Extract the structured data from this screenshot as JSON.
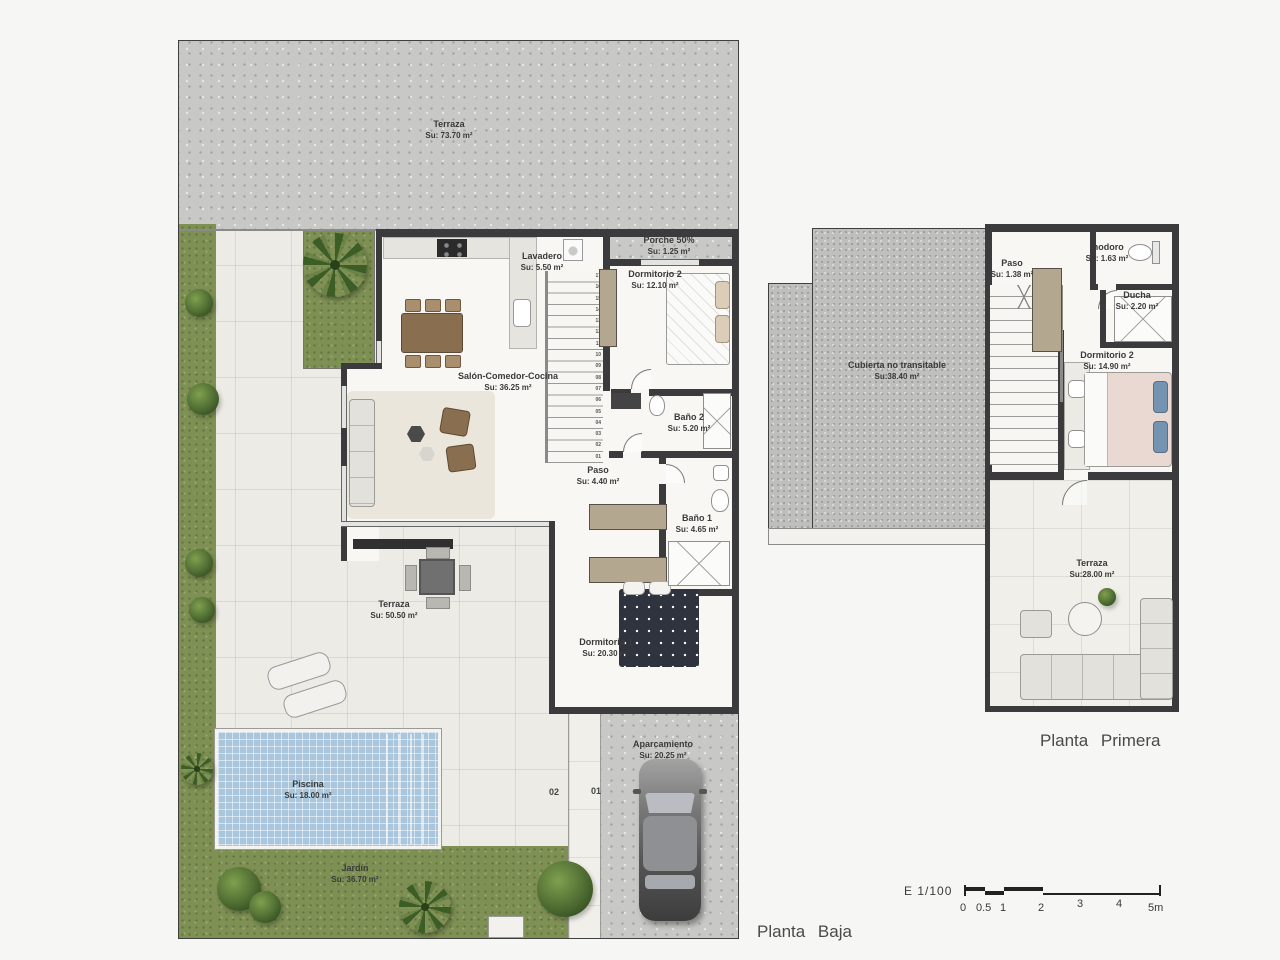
{
  "plans": {
    "pb": {
      "title": "Planta Baja",
      "rooms": {
        "terraza_top": {
          "name": "Terraza",
          "area": "Su: 73.70 m²"
        },
        "lavadero": {
          "name": "Lavadero",
          "area": "Su: 5.50 m²"
        },
        "porche": {
          "name": "Porche 50%",
          "area": "Su: 1.25 m²"
        },
        "dormitorio2": {
          "name": "Dormitorio 2",
          "area": "Su: 12.10 m²"
        },
        "salon": {
          "name": "Salón-Comedor-Cocina",
          "area": "Su: 36.25 m²"
        },
        "bano2": {
          "name": "Baño 2",
          "area": "Su: 5.20 m²"
        },
        "paso": {
          "name": "Paso",
          "area": "Su: 4.40 m²"
        },
        "bano1": {
          "name": "Baño 1",
          "area": "Su: 4.65 m²"
        },
        "dormitorio1": {
          "name": "Dormitorio 1",
          "area": "Su: 20.30 m²"
        },
        "terraza": {
          "name": "Terraza",
          "area": "Su: 50.50 m²"
        },
        "piscina": {
          "name": "Piscina",
          "area": "Su: 18.00 m²"
        },
        "jardin": {
          "name": "Jardín",
          "area": "Su: 36.70 m²"
        },
        "aparcamiento": {
          "name": "Aparcamiento",
          "area": "Su: 20.25 m²"
        }
      },
      "parking": [
        "02",
        "01"
      ],
      "stairs": [
        "17",
        "16",
        "15",
        "14",
        "13",
        "12",
        "11",
        "10",
        "09",
        "08",
        "07",
        "06",
        "05",
        "04",
        "03",
        "02",
        "01"
      ]
    },
    "pp": {
      "title": "Planta Primera",
      "rooms": {
        "cubierta": {
          "name": "Cubierta no transitable",
          "area": "Su:38.40 m²"
        },
        "paso": {
          "name": "Paso",
          "area": "Su: 1.38 m²"
        },
        "inodoro": {
          "name": "Inodoro",
          "area": "Su: 1.63 m²"
        },
        "ducha": {
          "name": "Ducha",
          "area": "Su: 2.20 m²"
        },
        "dormitorio2": {
          "name": "Dormitorio 2",
          "area": "Su: 14.90 m²"
        },
        "terraza": {
          "name": "Terraza",
          "area": "Su:28.00 m²"
        }
      }
    }
  },
  "scale": {
    "label": "E 1/100",
    "ticks": [
      "0",
      "0.5",
      "1",
      "2",
      "3",
      "4",
      "5m"
    ]
  },
  "colors": {
    "wall": "#3b3b3d",
    "concrete": "#c8c8c6",
    "tile": "#edebe5",
    "grass": "#7e9054",
    "pool": "#a9c6dc",
    "roof": "#bfbfbd",
    "wardrobe": "#b3a78f",
    "wood": "#8a6e50"
  }
}
